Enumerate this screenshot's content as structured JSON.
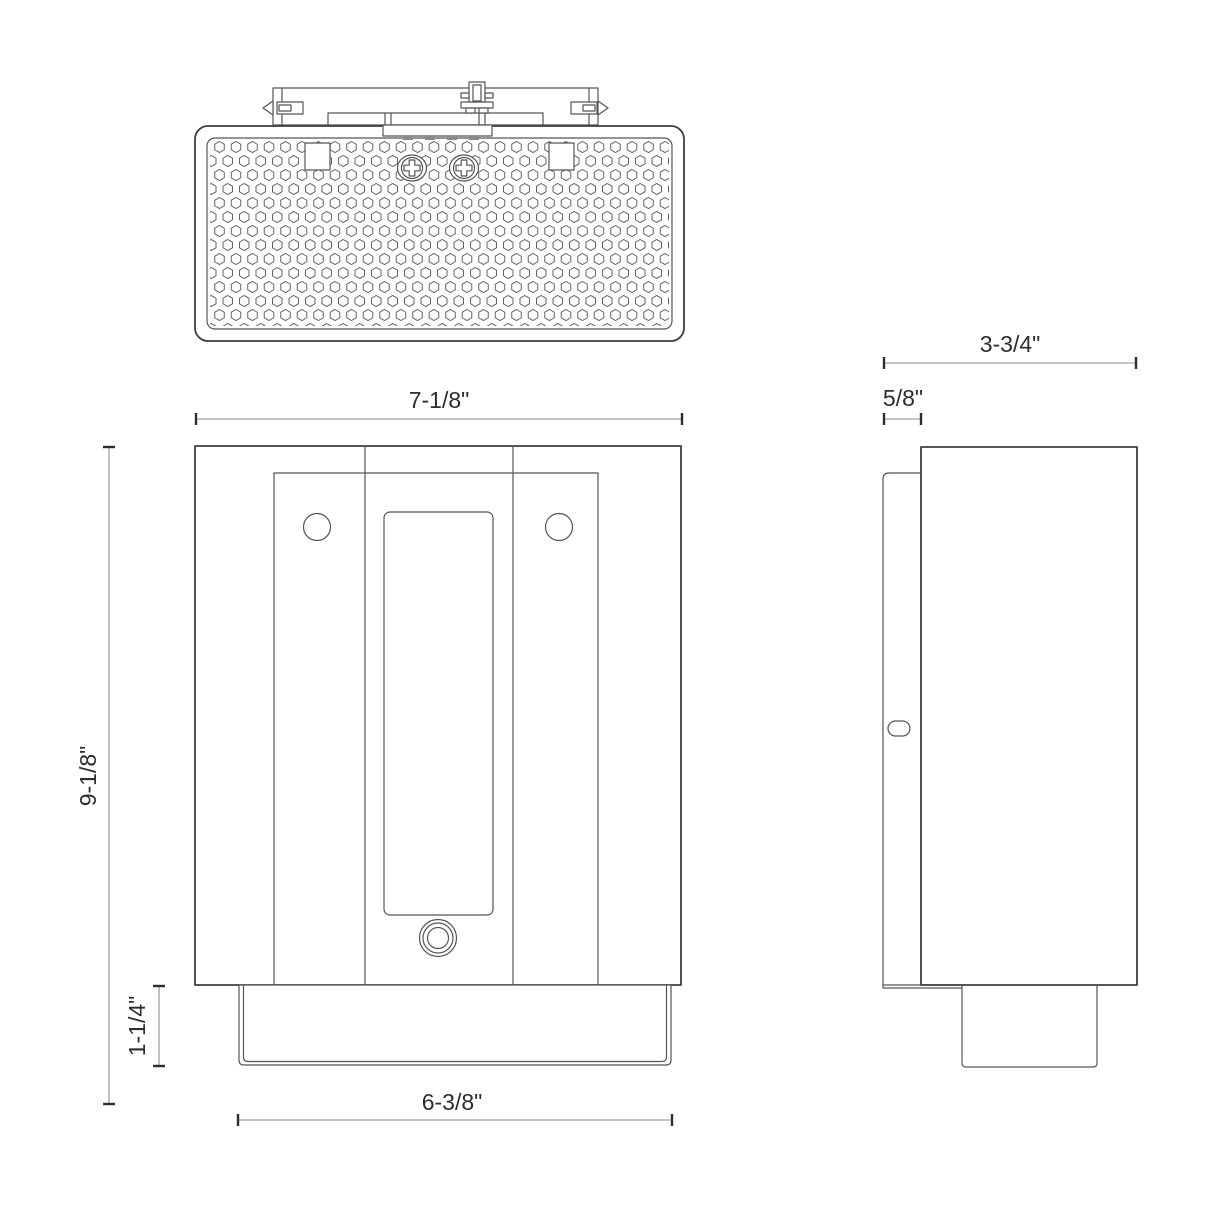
{
  "dimensions": {
    "front_width": "7-1/8\"",
    "front_height": "9-1/8\"",
    "bottom_height": "1-1/4\"",
    "bottom_width": "6-3/8\"",
    "side_depth": "3-3/4\"",
    "backplate_thickness": "5/8\""
  },
  "colors": {
    "line": "#3f3f3f",
    "line2": "#555555",
    "dim": "#8c8c8c",
    "text": "#2d2d2d",
    "hex": "#636363",
    "background": "#ffffff"
  }
}
